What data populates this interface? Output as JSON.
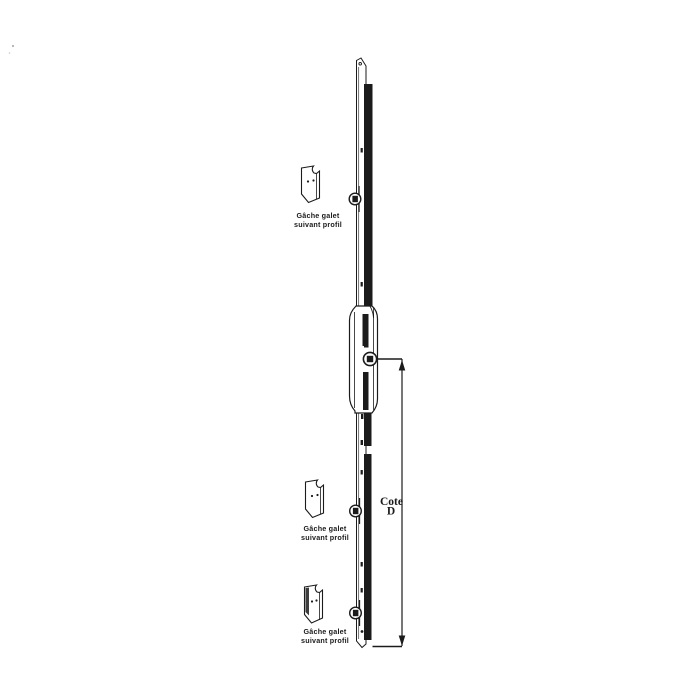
{
  "colors": {
    "ink": "#1b1b1b",
    "background": "#ffffff"
  },
  "strike_plates": [
    {
      "id": "top",
      "label": [
        "Gâche galet",
        "suivant profil"
      ]
    },
    {
      "id": "middle",
      "label": [
        "Gâche galet",
        "suivant profil"
      ]
    },
    {
      "id": "bottom",
      "label": [
        "Gâche galet",
        "suivant profil"
      ]
    }
  ],
  "dimension": {
    "label": [
      "Cote",
      "D"
    ]
  }
}
